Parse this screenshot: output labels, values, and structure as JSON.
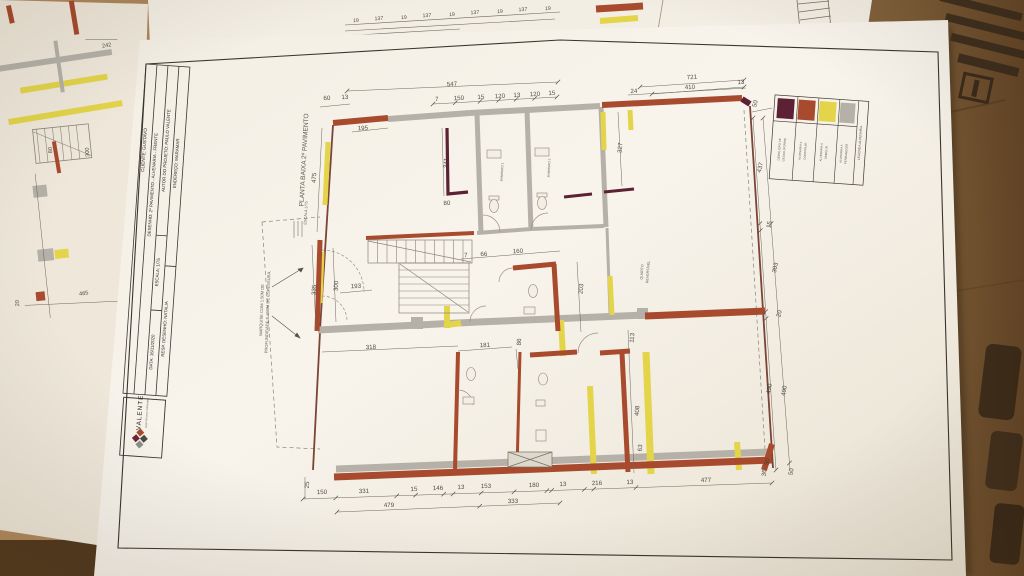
{
  "scene": {
    "description": "photo of architectural floor plan sheets on cardboard",
    "colors": {
      "cardboard": "#a9875c",
      "cardboard_dark": "#5d4426",
      "paper": "#f7f3ea",
      "wall_existing_gray": "#b5b1a8",
      "wall_demolish_yellow": "#e3d44a",
      "wall_build_red": "#a84a2d",
      "gesso_maroon": "#5c2134",
      "ink": "#3d3833"
    }
  },
  "sheet": {
    "drawing_title": "PLANTA BAIXA 2º PAVIMENTO",
    "drawing_scale": "ESCALA 1/75",
    "title_block": {
      "cliente": "CLIENTE: GUSTAVO",
      "desenho": "DESENHO: 2º PAVIMENTO - ALVENARIA - FRENTE",
      "autor": "AUTOR DO PROJETO: PAULO VALENTE",
      "escala": "ESCALA: 1/75",
      "data": "DATA: 16/11/2020",
      "endereco": "ENDEREÇO: MARAMAR",
      "resp": "RESP. DESENHO: NATALIA",
      "logo_name": "VALENTE",
      "logo_subtitle": "ARQUITETURA E INTERIORES"
    },
    "legend": {
      "title": "LEGENDA ALVENARIA",
      "items": [
        {
          "color": "#5c2134",
          "line1": "DEMOLIÇÃO DE",
          "line2": "GESSO (FORRO)"
        },
        {
          "color": "#a84a2d",
          "line1": "ALVENARIA A",
          "line2": "CONSTRUIR"
        },
        {
          "color": "#e3d44a",
          "line1": "ALVENARIA A",
          "line2": "DEMOLIR"
        },
        {
          "color": "#b5b1a8",
          "line1": "ALVENARIA A",
          "line2": "PERMANECER"
        }
      ]
    },
    "annotation_marquise": [
      "MARQUISE COM 1.50M DE",
      "PROFUNDIDADE E 40CM DE ESPESSURA."
    ],
    "room_labels": [
      {
        "t": "BANHEIRO 1",
        "x": 503,
        "y": 172,
        "r": -87,
        "s": 3.1
      },
      {
        "t": "BANHEIRO 2",
        "x": 550,
        "y": 168,
        "r": -87,
        "s": 3.1
      },
      {
        "t": "QUARTO",
        "x": 643,
        "y": 272,
        "r": -86,
        "s": 3.6
      },
      {
        "t": "REVERSÍVEL",
        "x": 649,
        "y": 272,
        "r": -86,
        "s": 3.6
      }
    ],
    "dimensions": [
      {
        "t": "60",
        "x": 327,
        "y": 100,
        "r": -3
      },
      {
        "t": "13",
        "x": 345,
        "y": 99,
        "r": -3
      },
      {
        "t": "547",
        "x": 452,
        "y": 86,
        "r": -3
      },
      {
        "t": "195",
        "x": 363,
        "y": 130,
        "r": -3
      },
      {
        "t": "7",
        "x": 437,
        "y": 101,
        "r": -3
      },
      {
        "t": "150",
        "x": 459,
        "y": 100,
        "r": -3
      },
      {
        "t": "15",
        "x": 481,
        "y": 99,
        "r": -3
      },
      {
        "t": "120",
        "x": 500,
        "y": 98,
        "r": -3
      },
      {
        "t": "13",
        "x": 517,
        "y": 97,
        "r": -3
      },
      {
        "t": "120",
        "x": 535,
        "y": 96,
        "r": -3
      },
      {
        "t": "15",
        "x": 552,
        "y": 95,
        "r": -3
      },
      {
        "t": "24",
        "x": 634,
        "y": 93,
        "r": -3
      },
      {
        "t": "410",
        "x": 690,
        "y": 89,
        "r": -3
      },
      {
        "t": "13",
        "x": 741,
        "y": 84,
        "r": -3
      },
      {
        "t": "721",
        "x": 692,
        "y": 79,
        "r": -3
      },
      {
        "t": "50",
        "x": 757,
        "y": 104,
        "r": -78
      },
      {
        "t": "475",
        "x": 316,
        "y": 178,
        "r": -87
      },
      {
        "t": "341",
        "x": 448,
        "y": 163,
        "r": -87
      },
      {
        "t": "80",
        "x": 447,
        "y": 205,
        "r": -3
      },
      {
        "t": "327",
        "x": 622,
        "y": 148,
        "r": -85
      },
      {
        "t": "437",
        "x": 762,
        "y": 168,
        "r": -76
      },
      {
        "t": "15",
        "x": 771,
        "y": 225,
        "r": -78
      },
      {
        "t": "303",
        "x": 777,
        "y": 268,
        "r": -78
      },
      {
        "t": "20",
        "x": 781,
        "y": 314,
        "r": -78
      },
      {
        "t": "490",
        "x": 771,
        "y": 389,
        "r": -80
      },
      {
        "t": "490",
        "x": 786,
        "y": 391,
        "r": -80
      },
      {
        "t": "30",
        "x": 769,
        "y": 462,
        "r": -80
      },
      {
        "t": "50",
        "x": 793,
        "y": 472,
        "r": -80
      },
      {
        "t": "335",
        "x": 316,
        "y": 290,
        "r": -87
      },
      {
        "t": "300",
        "x": 338,
        "y": 286,
        "r": -87
      },
      {
        "t": "193",
        "x": 356,
        "y": 288,
        "r": -3
      },
      {
        "t": "318",
        "x": 371,
        "y": 349,
        "r": -3
      },
      {
        "t": "7",
        "x": 466,
        "y": 257,
        "r": -3
      },
      {
        "t": "66",
        "x": 484,
        "y": 256,
        "r": -3
      },
      {
        "t": "160",
        "x": 518,
        "y": 253,
        "r": -3
      },
      {
        "t": "203",
        "x": 583,
        "y": 289,
        "r": -85
      },
      {
        "t": "181",
        "x": 485,
        "y": 347,
        "r": -3
      },
      {
        "t": "86",
        "x": 521,
        "y": 342,
        "r": -87
      },
      {
        "t": "113",
        "x": 634,
        "y": 338,
        "r": -85
      },
      {
        "t": "408",
        "x": 639,
        "y": 411,
        "r": -85
      },
      {
        "t": "63",
        "x": 642,
        "y": 448,
        "r": -85
      },
      {
        "t": "150",
        "x": 322,
        "y": 494,
        "r": -2
      },
      {
        "t": "25",
        "x": 309,
        "y": 485,
        "r": -88
      },
      {
        "t": "331",
        "x": 364,
        "y": 493,
        "r": -2
      },
      {
        "t": "15",
        "x": 414,
        "y": 491,
        "r": -2
      },
      {
        "t": "146",
        "x": 438,
        "y": 490,
        "r": -2
      },
      {
        "t": "13",
        "x": 461,
        "y": 489,
        "r": -2
      },
      {
        "t": "153",
        "x": 486,
        "y": 488,
        "r": -2
      },
      {
        "t": "180",
        "x": 534,
        "y": 487,
        "r": -2
      },
      {
        "t": "13",
        "x": 563,
        "y": 486,
        "r": -2
      },
      {
        "t": "216",
        "x": 597,
        "y": 485,
        "r": -2
      },
      {
        "t": "13",
        "x": 630,
        "y": 484,
        "r": -2
      },
      {
        "t": "477",
        "x": 706,
        "y": 482,
        "r": -2
      },
      {
        "t": "479",
        "x": 389,
        "y": 507,
        "r": -2
      },
      {
        "t": "333",
        "x": 513,
        "y": 503,
        "r": -2
      },
      {
        "t": "36",
        "x": 766,
        "y": 473,
        "r": -85
      }
    ]
  },
  "under_sheet_left": {
    "dimensions": [
      {
        "t": "242",
        "x": 107,
        "y": 47,
        "r": -10
      },
      {
        "t": "80",
        "x": 52,
        "y": 150,
        "r": -95
      },
      {
        "t": "300",
        "x": 89,
        "y": 152,
        "r": -95
      },
      {
        "t": "465",
        "x": 84,
        "y": 295,
        "r": -8
      },
      {
        "t": "20",
        "x": 19,
        "y": 303,
        "r": -95
      }
    ]
  },
  "under_sheet_top": {
    "dimensions": [
      {
        "t": "19",
        "x": 356,
        "y": 22,
        "r": -3
      },
      {
        "t": "137",
        "x": 379,
        "y": 20,
        "r": -3
      },
      {
        "t": "19",
        "x": 404,
        "y": 19,
        "r": -3
      },
      {
        "t": "137",
        "x": 427,
        "y": 17,
        "r": -3
      },
      {
        "t": "19",
        "x": 452,
        "y": 16,
        "r": -3
      },
      {
        "t": "137",
        "x": 475,
        "y": 14,
        "r": -3
      },
      {
        "t": "19",
        "x": 500,
        "y": 13,
        "r": -3
      },
      {
        "t": "137",
        "x": 523,
        "y": 11,
        "r": -3
      },
      {
        "t": "19",
        "x": 548,
        "y": 10,
        "r": -3
      }
    ]
  }
}
